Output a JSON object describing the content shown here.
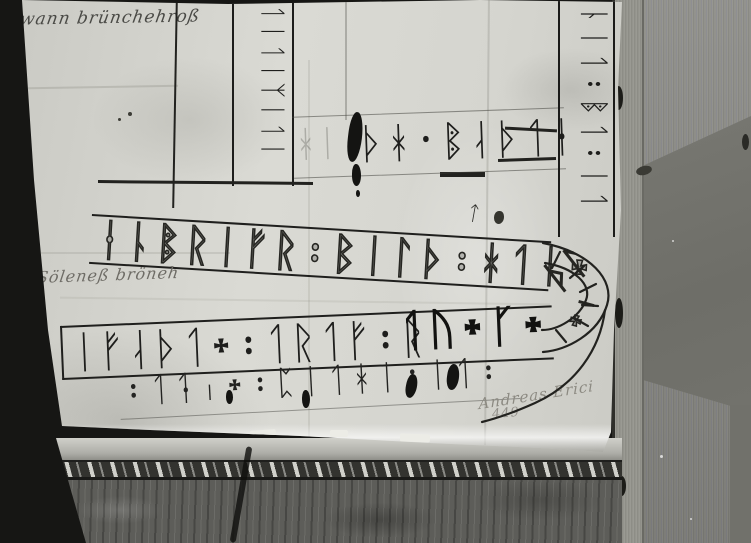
{
  "photo": {
    "background_color": "#161614",
    "paper_color": "#d6d6d0",
    "wood_color": "#8e8e86",
    "marble_color": "#5d5d59",
    "ink_color": "#1e1e1c"
  },
  "inscription": {
    "top_vertical_band_runes": "ᛐᛁᛐᛁᛉᛁᛐᛁ",
    "top_band_ghost_runes": "ᚼᛁ",
    "top_band_runes": "ᚦᚼ᛫ᛔᛆᚦᛐᚽ",
    "right_band_runes": "ᚿᛁᛐ᛬ᛔᛐ᛬ᛁᛐ",
    "middle_band_runes": "ᛂᚿᛔᚱᛁᚠᚱ᛬ᛒᛁᛚᚦ᛬ᚼᛐᛁ᛭",
    "middle_band_mark": "ᛏ",
    "loop_runes_upper": "ᚦᛚ",
    "loop_runes_lower": "᛭ᛧ",
    "lower_band_runes": "ᛁᚠᛆᚦᛐ᛭᛬ᛐᚱᛐᚠ᛬ᚱ",
    "lower_band_runes_bold": "ᛐᚢ᛭ᚴ᛭",
    "bottom_line_runes": "᛬ᛐᛑᛧ᛭᛬ᛈᛁᛐᚼᛁ᛬ᛁᛐ᛬"
  },
  "annotations": {
    "top_left_cursive": "wann brünchehroß",
    "mid_left_cursive": "bir Söleneß bröneh",
    "signature": "Andreas Erici",
    "signature_number": "449"
  }
}
